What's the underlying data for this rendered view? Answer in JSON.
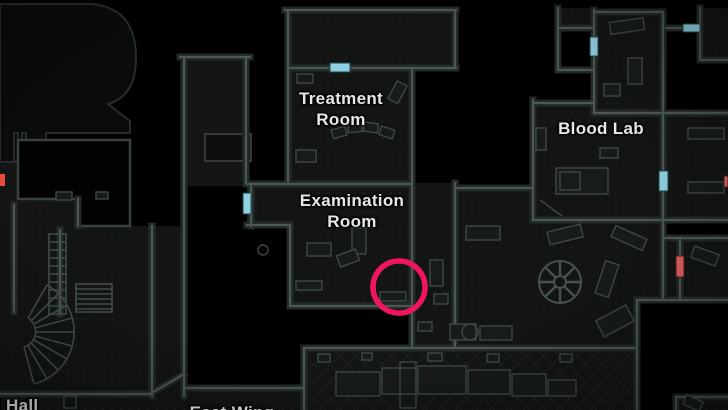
{
  "map": {
    "labels": {
      "treatment_line1": "Treatment",
      "treatment_line2": "Room",
      "examination_line1": "Examination",
      "examination_line2": "Room",
      "blood_lab": "Blood Lab",
      "hall_partial": "l Hall",
      "east_wing_partial": "East Wing"
    },
    "markers": {
      "objective_circle_color": "#f1145f",
      "door_blue_color": "#8ed1e1",
      "door_red_color": "#e06060",
      "edge_marker_red_color": "#ee4a3e"
    },
    "palette": {
      "background": "#000000",
      "room_fill": "#121514",
      "wall_line": "#4d5854",
      "label_text": "#e6e9e6"
    }
  }
}
